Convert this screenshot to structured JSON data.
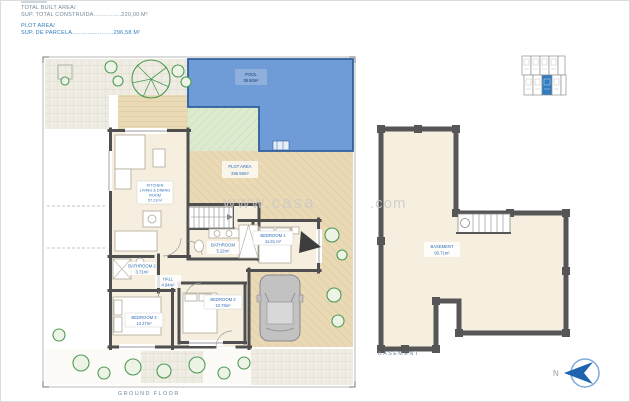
{
  "header": {
    "built_area_label": "TOTAL BUILT AREA/",
    "built_area_value": "SUP. TOTAL CONSTRUIDA................220,00 M²",
    "plot_area_label": "PLOT AREA/",
    "plot_area_value": "SUP. DE PARCELA........................296,58 M²"
  },
  "rooms": {
    "pool": {
      "name": "POOL",
      "area": "39.50m²"
    },
    "plot_area": {
      "name": "PLOT AREA",
      "area": "296.58m²"
    },
    "kitchen_living": {
      "line1": "KITCHEN",
      "line2": "LIVING & DINING",
      "line3": "ROOM",
      "area": "57.21m²"
    },
    "bedroom1": {
      "name": "BEDROOM 1",
      "area": "11.61 m²"
    },
    "bedroom2": {
      "name": "BEDROOM 2",
      "area": "10.76m²"
    },
    "bedroom3": {
      "name": "BEDROOM 3",
      "area": "13.27m²"
    },
    "bathroom": {
      "name": "BATHROOM",
      "area": "5.22m²"
    },
    "bathroom2": {
      "name": "BATHROOM 2",
      "area": "3.71m²"
    },
    "hall": {
      "name": "HALL",
      "area": "4.94m²"
    },
    "basement": {
      "name": "BASEMENT",
      "area": "93.71m²"
    }
  },
  "captions": {
    "ground": "GROUND FLOOR",
    "basement": "BASEMENT"
  },
  "compass": {
    "label": "N"
  },
  "watermark": {
    "left": "www.casa",
    "right": ".com"
  },
  "colors": {
    "accent_blue": "#2e7dc0",
    "label_blue": "#2f6db8",
    "pool_fill": "#6f9cd6",
    "wall_gray": "#4f4f4f",
    "deck_tan": "#ead9b5",
    "lawn_green": "#dcebcf",
    "caption_gray": "#6d87a0"
  }
}
